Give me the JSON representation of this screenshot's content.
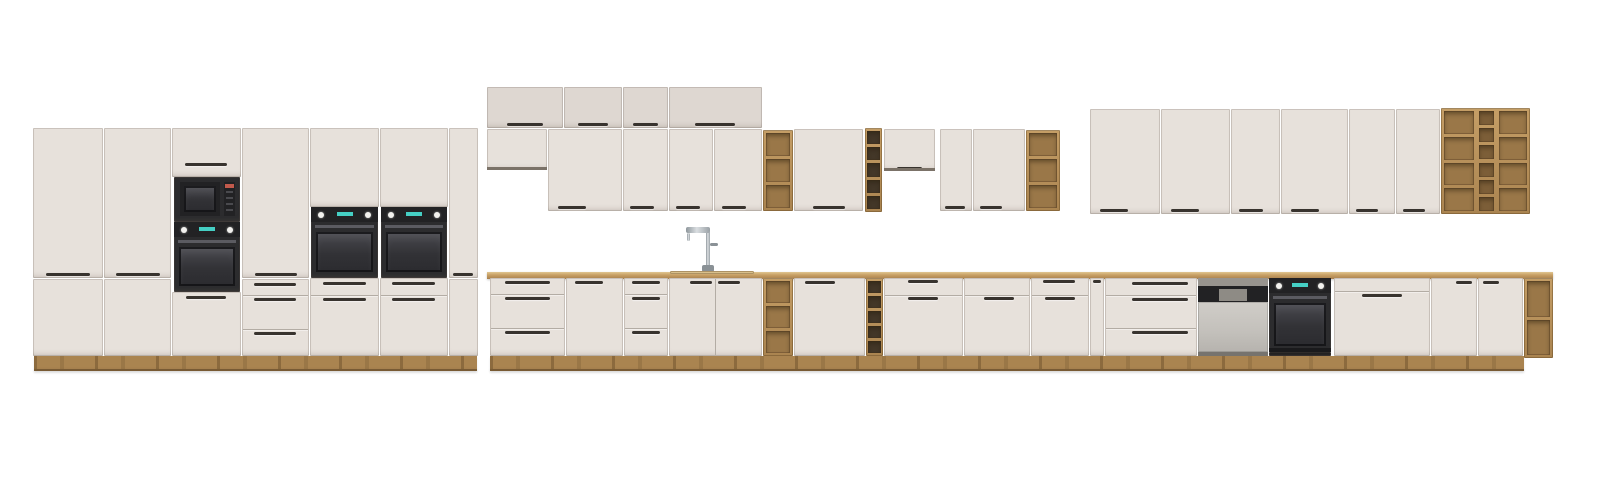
{
  "meta": {
    "description": "Product render of a modular kitchen cabinet set on a white background: left bank of tall larder units with built-in black microwave and three black ovens, a middle run of wall cabinets with top boxes, oak open-shelf and wine-rack inserts, a continuous oak worktop with chrome faucet over a sink cabinet, base units with drawers and doors, a semi-integrated dishwasher, a built-in black oven, and an oak open shelving unit at the right end.",
    "visible_text": []
  },
  "scene": {
    "width": 1600,
    "height": 482,
    "background": "#ffffff"
  },
  "palette": {
    "front": "#e7e1db",
    "front2": "#ded7d1",
    "seam": "#b3aca4",
    "handle": "#38332e",
    "wood": "#b38c57",
    "woodLight": "#cfa972",
    "woodDark": "#8c6b3f",
    "woodBack": "#9a7748",
    "woodBack2": "#7c5e38",
    "rackDark": "#433728",
    "appl": "#2c2c2e",
    "applDark": "#222224",
    "glass": "#3a3a3e",
    "bar": "#5b5b61",
    "knob": "#f2f1ee",
    "display": "#45cfc4",
    "steel": "#c7c4bf",
    "chrome": "#b6bcc0",
    "plinthWood": "#aa8450",
    "darkReveal": "#7b7268"
  },
  "units": [
    {
      "id": "tall-door-1-upper",
      "kind": "box",
      "x": 33,
      "y": 128,
      "w": 70,
      "h": 150,
      "handles": [
        {
          "x": 13,
          "y": 145,
          "w": 44
        }
      ]
    },
    {
      "id": "tall-door-1-lower",
      "kind": "box",
      "x": 33,
      "y": 279,
      "w": 70,
      "h": 77
    },
    {
      "id": "tall-door-2-upper",
      "kind": "box",
      "x": 104,
      "y": 128,
      "w": 67,
      "h": 150,
      "handles": [
        {
          "x": 12,
          "y": 145,
          "w": 44
        }
      ]
    },
    {
      "id": "tall-door-2-lower",
      "kind": "box",
      "x": 104,
      "y": 279,
      "w": 67,
      "h": 77
    },
    {
      "id": "micro-column-top-door",
      "kind": "box",
      "x": 172,
      "y": 128,
      "w": 69,
      "h": 49,
      "handles": [
        {
          "x": 13,
          "y": 35,
          "w": 42
        }
      ]
    },
    {
      "id": "built-in-microwave",
      "kind": "microwave",
      "x": 174,
      "y": 177,
      "w": 66,
      "h": 45
    },
    {
      "id": "built-in-oven-1",
      "kind": "oven",
      "x": 174,
      "y": 222,
      "w": 66,
      "h": 70
    },
    {
      "id": "micro-column-bottom-door",
      "kind": "box",
      "x": 172,
      "y": 292,
      "w": 69,
      "h": 64,
      "handles": [
        {
          "x": 14,
          "y": 4,
          "w": 40
        }
      ]
    },
    {
      "id": "tall-door-3-upper",
      "kind": "box",
      "x": 242,
      "y": 128,
      "w": 67,
      "h": 150,
      "handles": [
        {
          "x": 13,
          "y": 145,
          "w": 42
        }
      ]
    },
    {
      "id": "tall-drawers-1",
      "kind": "box",
      "x": 242,
      "y": 279,
      "w": 67,
      "h": 77,
      "hseams": [
        16,
        50
      ],
      "handles": [
        {
          "x": 12,
          "y": 4,
          "w": 42
        },
        {
          "x": 12,
          "y": 19,
          "w": 42
        },
        {
          "x": 12,
          "y": 53,
          "w": 42
        }
      ]
    },
    {
      "id": "oven-column-1-top-door",
      "kind": "box",
      "x": 310,
      "y": 128,
      "w": 69,
      "h": 79
    },
    {
      "id": "built-in-oven-2",
      "kind": "oven",
      "x": 311,
      "y": 207,
      "w": 67,
      "h": 71
    },
    {
      "id": "oven-column-1-drawers",
      "kind": "box",
      "x": 310,
      "y": 278,
      "w": 69,
      "h": 78,
      "hseams": [
        17
      ],
      "handles": [
        {
          "x": 13,
          "y": 4,
          "w": 43
        },
        {
          "x": 13,
          "y": 20,
          "w": 43
        }
      ]
    },
    {
      "id": "oven-column-2-top-door",
      "kind": "box",
      "x": 380,
      "y": 128,
      "w": 68,
      "h": 79
    },
    {
      "id": "built-in-oven-3",
      "kind": "oven",
      "x": 381,
      "y": 207,
      "w": 66,
      "h": 71
    },
    {
      "id": "oven-column-2-drawers",
      "kind": "box",
      "x": 380,
      "y": 278,
      "w": 68,
      "h": 78,
      "hseams": [
        17
      ],
      "handles": [
        {
          "x": 12,
          "y": 4,
          "w": 43
        },
        {
          "x": 12,
          "y": 20,
          "w": 43
        }
      ]
    },
    {
      "id": "tall-door-4-upper",
      "kind": "box",
      "x": 449,
      "y": 128,
      "w": 29,
      "h": 150,
      "handles": [
        {
          "x": 4,
          "y": 145,
          "w": 20
        }
      ]
    },
    {
      "id": "tall-door-4-lower",
      "kind": "box",
      "x": 449,
      "y": 279,
      "w": 29,
      "h": 77
    },
    {
      "id": "top-box-1",
      "kind": "box",
      "x": 487,
      "y": 87,
      "w": 76,
      "h": 41,
      "f": "front2",
      "handles": [
        {
          "x": 20,
          "y": 36,
          "w": 36
        }
      ]
    },
    {
      "id": "top-box-2",
      "kind": "box",
      "x": 564,
      "y": 87,
      "w": 58,
      "h": 41,
      "f": "front2",
      "handles": [
        {
          "x": 14,
          "y": 36,
          "w": 30
        }
      ]
    },
    {
      "id": "top-box-3",
      "kind": "box",
      "x": 623,
      "y": 87,
      "w": 45,
      "h": 41,
      "f": "front2",
      "handles": [
        {
          "x": 10,
          "y": 36,
          "w": 25
        }
      ]
    },
    {
      "id": "top-box-4",
      "kind": "box",
      "x": 669,
      "y": 87,
      "w": 93,
      "h": 41,
      "f": "front2",
      "handles": [
        {
          "x": 26,
          "y": 36,
          "w": 40
        }
      ]
    },
    {
      "id": "wall-cab-short-1",
      "kind": "box",
      "x": 487,
      "y": 129,
      "w": 60,
      "h": 41,
      "dark": true
    },
    {
      "id": "wall-cab-1",
      "kind": "box",
      "x": 548,
      "y": 129,
      "w": 74,
      "h": 82,
      "handles": [
        {
          "x": 10,
          "y": 77,
          "w": 28
        }
      ]
    },
    {
      "id": "wall-cab-2",
      "kind": "box",
      "x": 623,
      "y": 129,
      "w": 45,
      "h": 82,
      "handles": [
        {
          "x": 7,
          "y": 77,
          "w": 24
        }
      ]
    },
    {
      "id": "wall-cab-3",
      "kind": "box",
      "x": 669,
      "y": 129,
      "w": 44,
      "h": 82,
      "handles": [
        {
          "x": 7,
          "y": 77,
          "w": 24
        }
      ]
    },
    {
      "id": "wall-cab-4",
      "kind": "box",
      "x": 714,
      "y": 129,
      "w": 48,
      "h": 82,
      "handles": [
        {
          "x": 8,
          "y": 77,
          "w": 24
        }
      ]
    },
    {
      "id": "wall-open-shelf-1",
      "kind": "shelf",
      "x": 763,
      "y": 130,
      "w": 30,
      "h": 81,
      "cols": [
        {
          "x": 3,
          "w": 24,
          "rows": 3,
          "f": "woodBack"
        }
      ]
    },
    {
      "id": "wall-cab-5",
      "kind": "box",
      "x": 794,
      "y": 129,
      "w": 69,
      "h": 82,
      "handles": [
        {
          "x": 19,
          "y": 77,
          "w": 32
        }
      ]
    },
    {
      "id": "wall-wine-rack",
      "kind": "shelf",
      "x": 865,
      "y": 128,
      "w": 17,
      "h": 84,
      "cols": [
        {
          "x": 2,
          "w": 13,
          "rows": 5,
          "f": "rackDark"
        }
      ]
    },
    {
      "id": "wall-cab-short-2",
      "kind": "box",
      "x": 884,
      "y": 129,
      "w": 51,
      "h": 42,
      "dark": true,
      "handles": [
        {
          "x": 13,
          "y": 38,
          "w": 25
        }
      ]
    },
    {
      "id": "wall-cab-6",
      "kind": "box",
      "x": 940,
      "y": 129,
      "w": 32,
      "h": 82,
      "handles": [
        {
          "x": 5,
          "y": 77,
          "w": 20
        }
      ]
    },
    {
      "id": "wall-cab-7",
      "kind": "box",
      "x": 973,
      "y": 129,
      "w": 52,
      "h": 82,
      "handles": [
        {
          "x": 7,
          "y": 77,
          "w": 22
        }
      ]
    },
    {
      "id": "wall-open-shelf-2",
      "kind": "shelf",
      "x": 1026,
      "y": 130,
      "w": 34,
      "h": 81,
      "cols": [
        {
          "x": 3,
          "w": 28,
          "rows": 3,
          "f": "woodBack"
        }
      ]
    },
    {
      "id": "wall-cab-8",
      "kind": "box",
      "x": 1090,
      "y": 109,
      "w": 70,
      "h": 105,
      "handles": [
        {
          "x": 10,
          "y": 100,
          "w": 28
        }
      ]
    },
    {
      "id": "wall-cab-9",
      "kind": "box",
      "x": 1161,
      "y": 109,
      "w": 69,
      "h": 105,
      "handles": [
        {
          "x": 10,
          "y": 100,
          "w": 28
        }
      ]
    },
    {
      "id": "wall-cab-10",
      "kind": "box",
      "x": 1231,
      "y": 109,
      "w": 49,
      "h": 105,
      "handles": [
        {
          "x": 8,
          "y": 100,
          "w": 24
        }
      ]
    },
    {
      "id": "wall-cab-11",
      "kind": "box",
      "x": 1281,
      "y": 109,
      "w": 67,
      "h": 105,
      "handles": [
        {
          "x": 10,
          "y": 100,
          "w": 28
        }
      ]
    },
    {
      "id": "wall-cab-12",
      "kind": "box",
      "x": 1349,
      "y": 109,
      "w": 46,
      "h": 105,
      "handles": [
        {
          "x": 7,
          "y": 100,
          "w": 22
        }
      ]
    },
    {
      "id": "wall-cab-13",
      "kind": "box",
      "x": 1396,
      "y": 109,
      "w": 44,
      "h": 105,
      "handles": [
        {
          "x": 7,
          "y": 100,
          "w": 22
        }
      ]
    },
    {
      "id": "wall-shelving-unit",
      "kind": "shelf",
      "x": 1441,
      "y": 108,
      "w": 89,
      "h": 106,
      "cols": [
        {
          "x": 3,
          "w": 30,
          "rows": 4,
          "f": "woodBack"
        },
        {
          "x": 38,
          "w": 15,
          "rows": 6,
          "f": "woodBack2"
        },
        {
          "x": 58,
          "w": 28,
          "rows": 4,
          "f": "woodBack"
        }
      ]
    },
    {
      "id": "faucet",
      "kind": "faucet",
      "x": 686,
      "y": 225,
      "w": 32,
      "h": 47
    },
    {
      "id": "worktop",
      "kind": "worktop",
      "x": 487,
      "y": 272,
      "w": 1066,
      "h": 7
    },
    {
      "id": "sink-rim",
      "kind": "sink",
      "x": 670,
      "y": 271,
      "w": 84,
      "h": 3
    },
    {
      "id": "base-drawers-1",
      "kind": "box",
      "x": 490,
      "y": 278,
      "w": 75,
      "h": 78,
      "hseams": [
        16,
        50
      ],
      "handles": [
        {
          "x": 15,
          "y": 3,
          "w": 45
        },
        {
          "x": 15,
          "y": 19,
          "w": 45
        },
        {
          "x": 15,
          "y": 53,
          "w": 45
        }
      ]
    },
    {
      "id": "base-door-1",
      "kind": "box",
      "x": 566,
      "y": 278,
      "w": 57,
      "h": 78,
      "handles": [
        {
          "x": 9,
          "y": 3,
          "w": 28
        }
      ]
    },
    {
      "id": "base-drawers-2",
      "kind": "box",
      "x": 624,
      "y": 278,
      "w": 44,
      "h": 78,
      "hseams": [
        16,
        50
      ],
      "handles": [
        {
          "x": 8,
          "y": 3,
          "w": 28
        },
        {
          "x": 8,
          "y": 19,
          "w": 28
        },
        {
          "x": 8,
          "y": 53,
          "w": 28
        }
      ]
    },
    {
      "id": "sink-cabinet",
      "kind": "box",
      "x": 669,
      "y": 278,
      "w": 93,
      "h": 78,
      "vseams": [
        46
      ],
      "handles": [
        {
          "x": 21,
          "y": 3,
          "w": 22
        },
        {
          "x": 49,
          "y": 3,
          "w": 22
        }
      ]
    },
    {
      "id": "base-open-shelf",
      "kind": "shelf",
      "x": 763,
      "y": 278,
      "w": 30,
      "h": 78,
      "cols": [
        {
          "x": 3,
          "w": 24,
          "rows": 3,
          "f": "woodBack"
        }
      ]
    },
    {
      "id": "base-door-2",
      "kind": "box",
      "x": 794,
      "y": 278,
      "w": 71,
      "h": 78,
      "handles": [
        {
          "x": 11,
          "y": 3,
          "w": 30
        }
      ]
    },
    {
      "id": "base-wine-rack",
      "kind": "shelf",
      "x": 866,
      "y": 278,
      "w": 17,
      "h": 78,
      "cols": [
        {
          "x": 2,
          "w": 13,
          "rows": 5,
          "f": "rackDark"
        }
      ]
    },
    {
      "id": "base-double-door",
      "kind": "box",
      "x": 884,
      "y": 278,
      "w": 79,
      "h": 78,
      "hseams": [
        17
      ],
      "handles": [
        {
          "x": 24,
          "y": 2,
          "w": 30
        },
        {
          "x": 24,
          "y": 19,
          "w": 30
        }
      ]
    },
    {
      "id": "base-drawer-door-1",
      "kind": "box",
      "x": 964,
      "y": 278,
      "w": 66,
      "h": 78,
      "hseams": [
        17
      ],
      "handles": [
        {
          "x": 20,
          "y": 19,
          "w": 30
        }
      ]
    },
    {
      "id": "base-drawer-door-2",
      "kind": "box",
      "x": 1031,
      "y": 278,
      "w": 58,
      "h": 78,
      "hseams": [
        17
      ],
      "handles": [
        {
          "x": 12,
          "y": 2,
          "w": 32
        },
        {
          "x": 14,
          "y": 19,
          "w": 30
        }
      ]
    },
    {
      "id": "base-filler",
      "kind": "box",
      "x": 1090,
      "y": 278,
      "w": 14,
      "h": 78,
      "handles": [
        {
          "x": 3,
          "y": 2,
          "w": 8
        }
      ]
    },
    {
      "id": "base-drawers-3",
      "kind": "box",
      "x": 1105,
      "y": 278,
      "w": 92,
      "h": 78,
      "hseams": [
        17,
        50
      ],
      "handles": [
        {
          "x": 27,
          "y": 4,
          "w": 56
        },
        {
          "x": 27,
          "y": 20,
          "w": 56
        },
        {
          "x": 27,
          "y": 53,
          "w": 56
        }
      ]
    },
    {
      "id": "dishwasher",
      "kind": "dishwasher",
      "x": 1198,
      "y": 278,
      "w": 70,
      "h": 78
    },
    {
      "id": "built-in-oven-4",
      "kind": "oven",
      "x": 1269,
      "y": 278,
      "w": 62,
      "h": 74,
      "base": true
    },
    {
      "id": "oven-plinth-strip",
      "kind": "box",
      "x": 1269,
      "y": 352,
      "w": 62,
      "h": 4,
      "f": "#1d1d1f"
    },
    {
      "id": "base-drawers-4",
      "kind": "box",
      "x": 1334,
      "y": 278,
      "w": 96,
      "h": 78,
      "hseams": [
        13
      ],
      "handles": [
        {
          "x": 28,
          "y": 16,
          "w": 40
        }
      ]
    },
    {
      "id": "base-door-3",
      "kind": "box",
      "x": 1431,
      "y": 278,
      "w": 46,
      "h": 78,
      "handles": [
        {
          "x": 25,
          "y": 3,
          "w": 16
        }
      ]
    },
    {
      "id": "base-door-4",
      "kind": "box",
      "x": 1478,
      "y": 278,
      "w": 45,
      "h": 78,
      "handles": [
        {
          "x": 5,
          "y": 3,
          "w": 16
        }
      ]
    },
    {
      "id": "base-end-shelf",
      "kind": "shelf",
      "x": 1524,
      "y": 278,
      "w": 29,
      "h": 80,
      "cols": [
        {
          "x": 3,
          "w": 23,
          "rows": 2,
          "f": "woodBack"
        }
      ]
    },
    {
      "id": "tall-plinth",
      "kind": "plinth",
      "x": 34,
      "y": 356,
      "w": 443,
      "h": 13
    },
    {
      "id": "base-plinth",
      "kind": "plinth",
      "x": 490,
      "y": 356,
      "w": 1034,
      "h": 13
    },
    {
      "id": "floor-shadow-left",
      "kind": "shadow",
      "x": 34,
      "y": 369,
      "w": 443,
      "h": 3
    },
    {
      "id": "floor-shadow-right",
      "kind": "shadow",
      "x": 490,
      "y": 369,
      "w": 1034,
      "h": 3
    }
  ]
}
